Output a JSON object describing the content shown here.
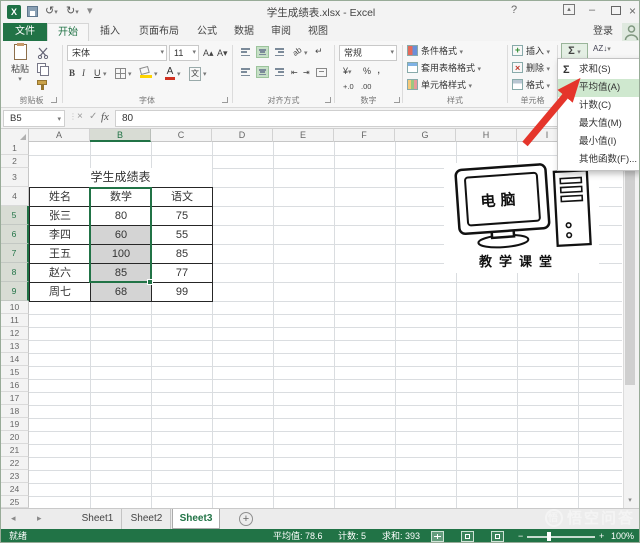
{
  "window": {
    "title": "学生成绩表.xlsx - Excel",
    "login_label": "登录",
    "help": "?"
  },
  "tabs": {
    "file": "文件",
    "items": [
      "开始",
      "插入",
      "页面布局",
      "公式",
      "数据",
      "审阅",
      "视图"
    ],
    "active": "开始"
  },
  "ribbon": {
    "paste": "粘贴",
    "clipboard_group": "剪贴板",
    "font_name": "宋体",
    "font_size": "11",
    "bold": "B",
    "italic": "I",
    "underline": "U",
    "font_group": "字体",
    "align_group": "对齐方式",
    "number_format": "常规",
    "currency": "¥",
    "percent": "%",
    "comma": ",",
    "inc_decimal": "+.0",
    "dec_decimal": ".00",
    "number_group": "数字",
    "conditional_format": "条件格式",
    "format_as_table": "套用表格格式",
    "cell_styles": "单元格样式",
    "styles_group": "样式",
    "insert": "插入",
    "delete": "删除",
    "format": "格式",
    "cells_group": "单元格",
    "autosum": "Σ"
  },
  "icons": {
    "undo": "↺",
    "redo": "↻",
    "dropdown": "▾",
    "check": "✓",
    "cancel": "×",
    "fx": "fx",
    "prev-sheet": "◂",
    "next-sheet": "▸",
    "add-sheet": "+",
    "minimize": "–",
    "close": "×",
    "help": "?",
    "sigma": "Σ",
    "sort-filter": "AZ↓",
    "wrap-text": "↵",
    "orientation": "ab",
    "grow-font": "A▴",
    "shrink-font": "A▾",
    "scroll-up": "▴",
    "scroll-down": "▾"
  },
  "formula_bar": {
    "name_box": "B5",
    "value": "80"
  },
  "grid": {
    "columns": [
      "A",
      "B",
      "C",
      "D",
      "E",
      "F",
      "G",
      "H",
      "I",
      "J"
    ],
    "row_count": 25,
    "selected_column": "B",
    "selected_rows": [
      5,
      6,
      7,
      8,
      9
    ],
    "active_cell": "B5",
    "table": {
      "title": "学生成绩表",
      "headers": [
        "姓名",
        "数学",
        "语文"
      ],
      "rows": [
        [
          "张三",
          "80",
          "75"
        ],
        [
          "李四",
          "60",
          "55"
        ],
        [
          "王五",
          "100",
          "85"
        ],
        [
          "赵六",
          "85",
          "77"
        ],
        [
          "周七",
          "68",
          "99"
        ]
      ]
    }
  },
  "autosum_menu": {
    "items": [
      {
        "label": "求和(S)",
        "icon": "Σ",
        "highlighted": false
      },
      {
        "label": "平均值(A)",
        "icon": "",
        "highlighted": true
      },
      {
        "label": "计数(C)",
        "icon": "",
        "highlighted": false
      },
      {
        "label": "最大值(M)",
        "icon": "",
        "highlighted": false
      },
      {
        "label": "最小值(I)",
        "icon": "",
        "highlighted": false
      },
      {
        "label": "其他函数(F)...",
        "icon": "",
        "highlighted": false
      }
    ]
  },
  "overlay_image": {
    "screen_text": "电脑",
    "caption": "教学课堂"
  },
  "sheet_tabs": {
    "items": [
      "Sheet1",
      "Sheet2",
      "Sheet3"
    ],
    "active": "Sheet3"
  },
  "status_bar": {
    "ready": "就绪",
    "average": "平均值: 78.6",
    "count": "计数: 5",
    "sum": "求和: 393",
    "zoom": "100%"
  },
  "watermark": "悟空问答",
  "colors": {
    "accent": "#217346",
    "menu_highlight": "#cfe8cf",
    "selection_fill": "#d4d4d4",
    "header_selected": "#d8dcd4",
    "arrow_red": "#e5352b",
    "grid_line": "#dadde0",
    "table_border": "#262626"
  }
}
